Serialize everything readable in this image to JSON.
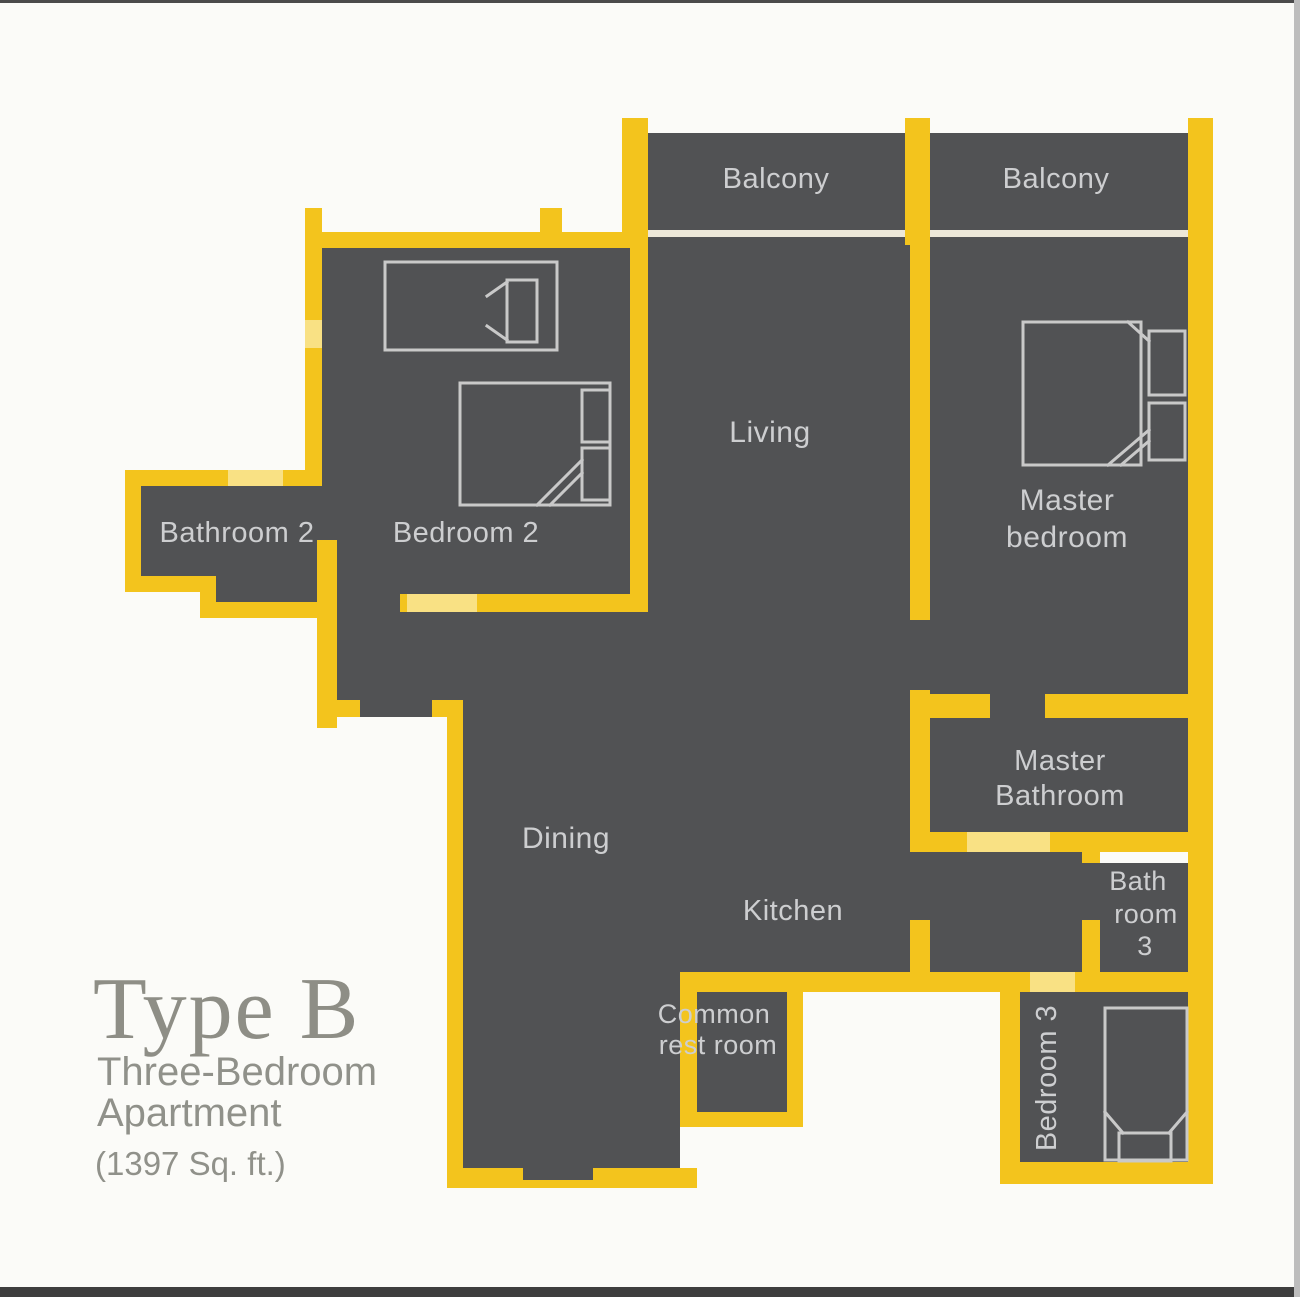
{
  "document": {
    "kind": "apartment floor plan",
    "plan_name": "Type B Three-Bedroom Apartment"
  },
  "title_block": {
    "type_label": "Type B",
    "subtitle_line1": "Three-Bedroom",
    "subtitle_line2": "Apartment",
    "area_label": "(1397 Sq. ft.)"
  },
  "rooms": {
    "balcony_left": "Balcony",
    "balcony_right": "Balcony",
    "living": "Living",
    "master_bedroom_line1": "Master",
    "master_bedroom_line2": "bedroom",
    "bathroom2": "Bathroom 2",
    "bedroom2": "Bedroom 2",
    "master_bathroom_line1": "Master",
    "master_bathroom_line2": "Bathroom",
    "dining": "Dining",
    "kitchen": "Kitchen",
    "bathroom3_line1": "Bath",
    "bathroom3_line2": "room",
    "bathroom3_line3": "3",
    "common_restroom_line1": "Common",
    "common_restroom_line2": "rest room",
    "bedroom3": "Bedroom 3"
  },
  "colors": {
    "floor": "#515254",
    "wall": "#F3C41D",
    "wall_door_light": "#F9E184",
    "balcony_glass_line": "#EDE8D9",
    "room_label": "#CDCED0",
    "furniture_outline": "#C9C9C9",
    "title_text": "#8E8E86",
    "background": "#FBFBF8"
  },
  "furniture": {
    "bedroom2_beds": [
      "single bed",
      "double bed"
    ],
    "master_bedroom_bed": "double bed",
    "bedroom3_bed": "single bed"
  }
}
